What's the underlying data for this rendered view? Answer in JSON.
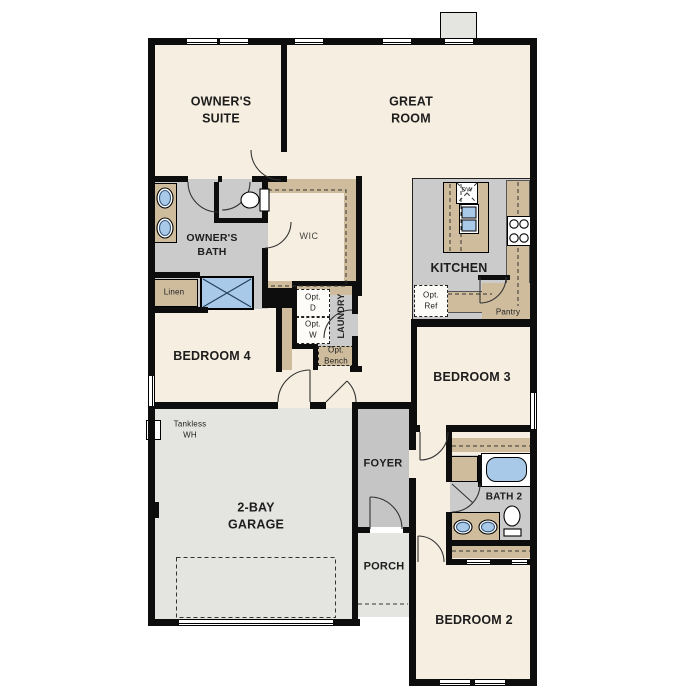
{
  "plan": {
    "type": "single-story floor plan",
    "palette": {
      "room_cream": "#f6eee0",
      "wet_floor_gray": "#cbcbcb",
      "garage_gray": "#e4e4e1",
      "cabinet_tan": "#cfbc9d",
      "fixture_blue": "#a9c9e8",
      "wall_black": "#0d0d0d"
    },
    "fixtures": [
      "toilet-icon",
      "double-sink-icon",
      "shower-x-icon",
      "bathtub-icon",
      "cooktop-icon",
      "dishwasher-icon",
      "island-sink-icon",
      "chimney-shape",
      "door-arc",
      "window-marker"
    ]
  },
  "labels": {
    "owners_suite": "OWNER'S\nSUITE",
    "great_room": "GREAT\nROOM",
    "owners_bath": "OWNER'S\nBATH",
    "wic": "WIC",
    "kitchen": "KITCHEN",
    "laundry": "LAUNDRY",
    "opt_d": "Opt.\nD",
    "opt_w": "Opt.\nW",
    "opt_bench": "Opt.\nBench",
    "linen_owners": "Linen",
    "linen_hall": "Linen",
    "bedroom4": "BEDROOM 4",
    "bedroom3": "BEDROOM 3",
    "bedroom2": "BEDROOM 2",
    "bath2": "BATH 2",
    "foyer": "FOYER",
    "porch": "PORCH",
    "garage": "2-BAY\nGARAGE",
    "tankless_wh": "Tankless\nWH",
    "opt_ref": "Opt.\nRef",
    "pantry": "Pantry",
    "dw": "DW"
  }
}
